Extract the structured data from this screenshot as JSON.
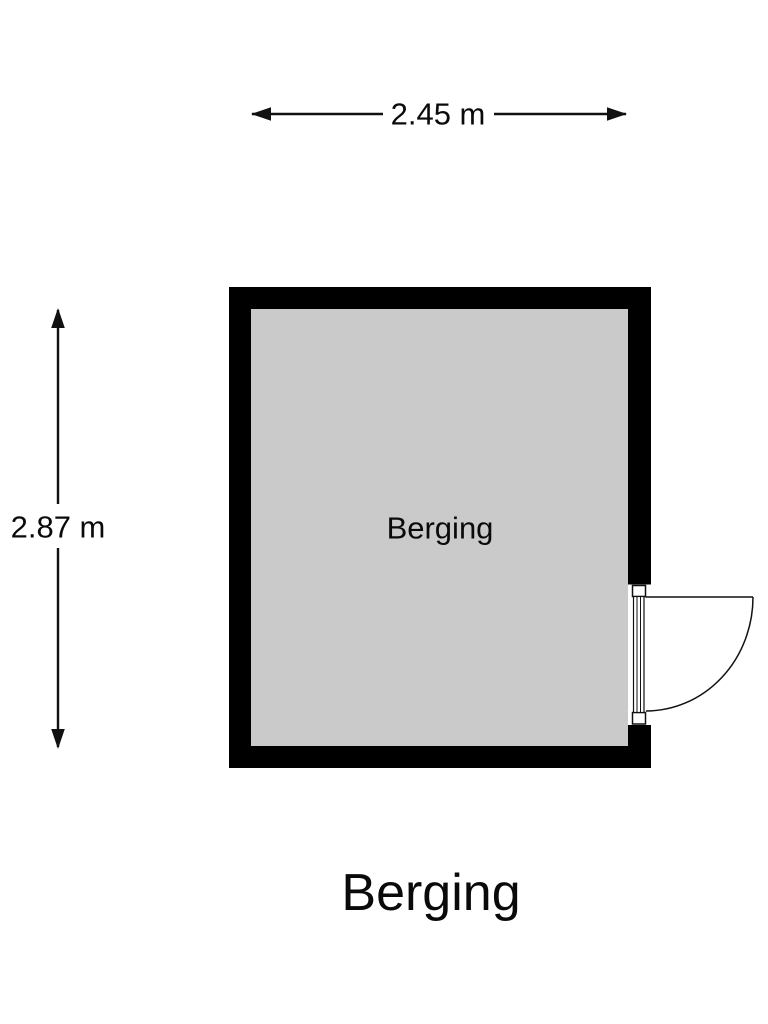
{
  "title": "Berging",
  "room": {
    "label": "Berging"
  },
  "dimensions": {
    "width_label": "2.45 m",
    "height_label": "2.87 m"
  },
  "door": {
    "location": "right wall, lower section",
    "swing": "opens outward to the right"
  },
  "colors": {
    "wall": "#000000",
    "floor": "#cacaca",
    "line": "#111111",
    "background": "#ffffff"
  }
}
